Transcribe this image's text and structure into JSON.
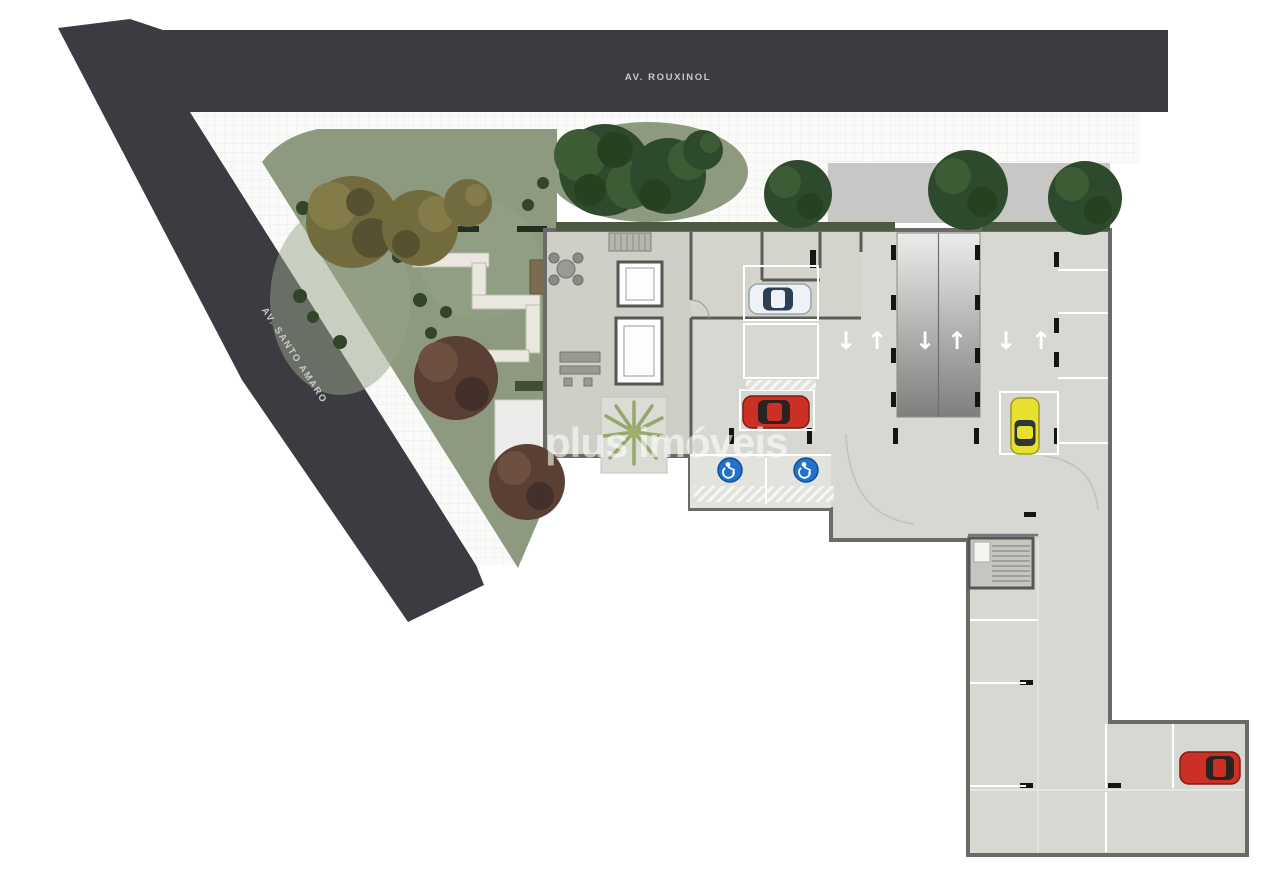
{
  "watermark": {
    "text": "plus imóveis",
    "color": "#ffffff"
  },
  "streets": [
    {
      "name": "AV. ROUXINOL",
      "surface_color": "#3b3b41",
      "label_color": "#c9c9ce"
    },
    {
      "name": "AV. SANTO AMARO",
      "surface_color": "#3b3b41",
      "label_color": "#c9c9ce"
    }
  ],
  "site": {
    "floor_color": "#d8d8d3",
    "lobby_floor_color": "#cfcfc7",
    "rooms_floor_color": "#d4d4cd",
    "driveway_color": "#c7c7c5",
    "sidewalk_color": "#fafaf8",
    "garden_color": "#8d9a7f",
    "outline_color": "#6a6a68",
    "accessible_area_color": "#e3e3de",
    "badge_color": "#2272cc",
    "arrow_down": "↓",
    "arrow_up": "↑"
  },
  "cars": [
    {
      "label": "white car",
      "color": "#eef2f6",
      "window_color": "#2e3f55",
      "orientation": "horizontal"
    },
    {
      "label": "red car center",
      "color": "#cc2f23",
      "window_color": "#2a2320",
      "orientation": "horizontal"
    },
    {
      "label": "yellow car",
      "color": "#e8e02e",
      "window_color": "#30343c",
      "orientation": "vertical"
    },
    {
      "label": "red car bottom",
      "color": "#cc2f23",
      "window_color": "#2a2320",
      "orientation": "horizontal"
    }
  ],
  "vegetation": {
    "dark_green": "#2e4a2c",
    "olive": "#716b3e",
    "red_brown": "#5a4034",
    "palm": "#9db06b",
    "bush": "#324529",
    "hedge": "#4c5a42"
  }
}
